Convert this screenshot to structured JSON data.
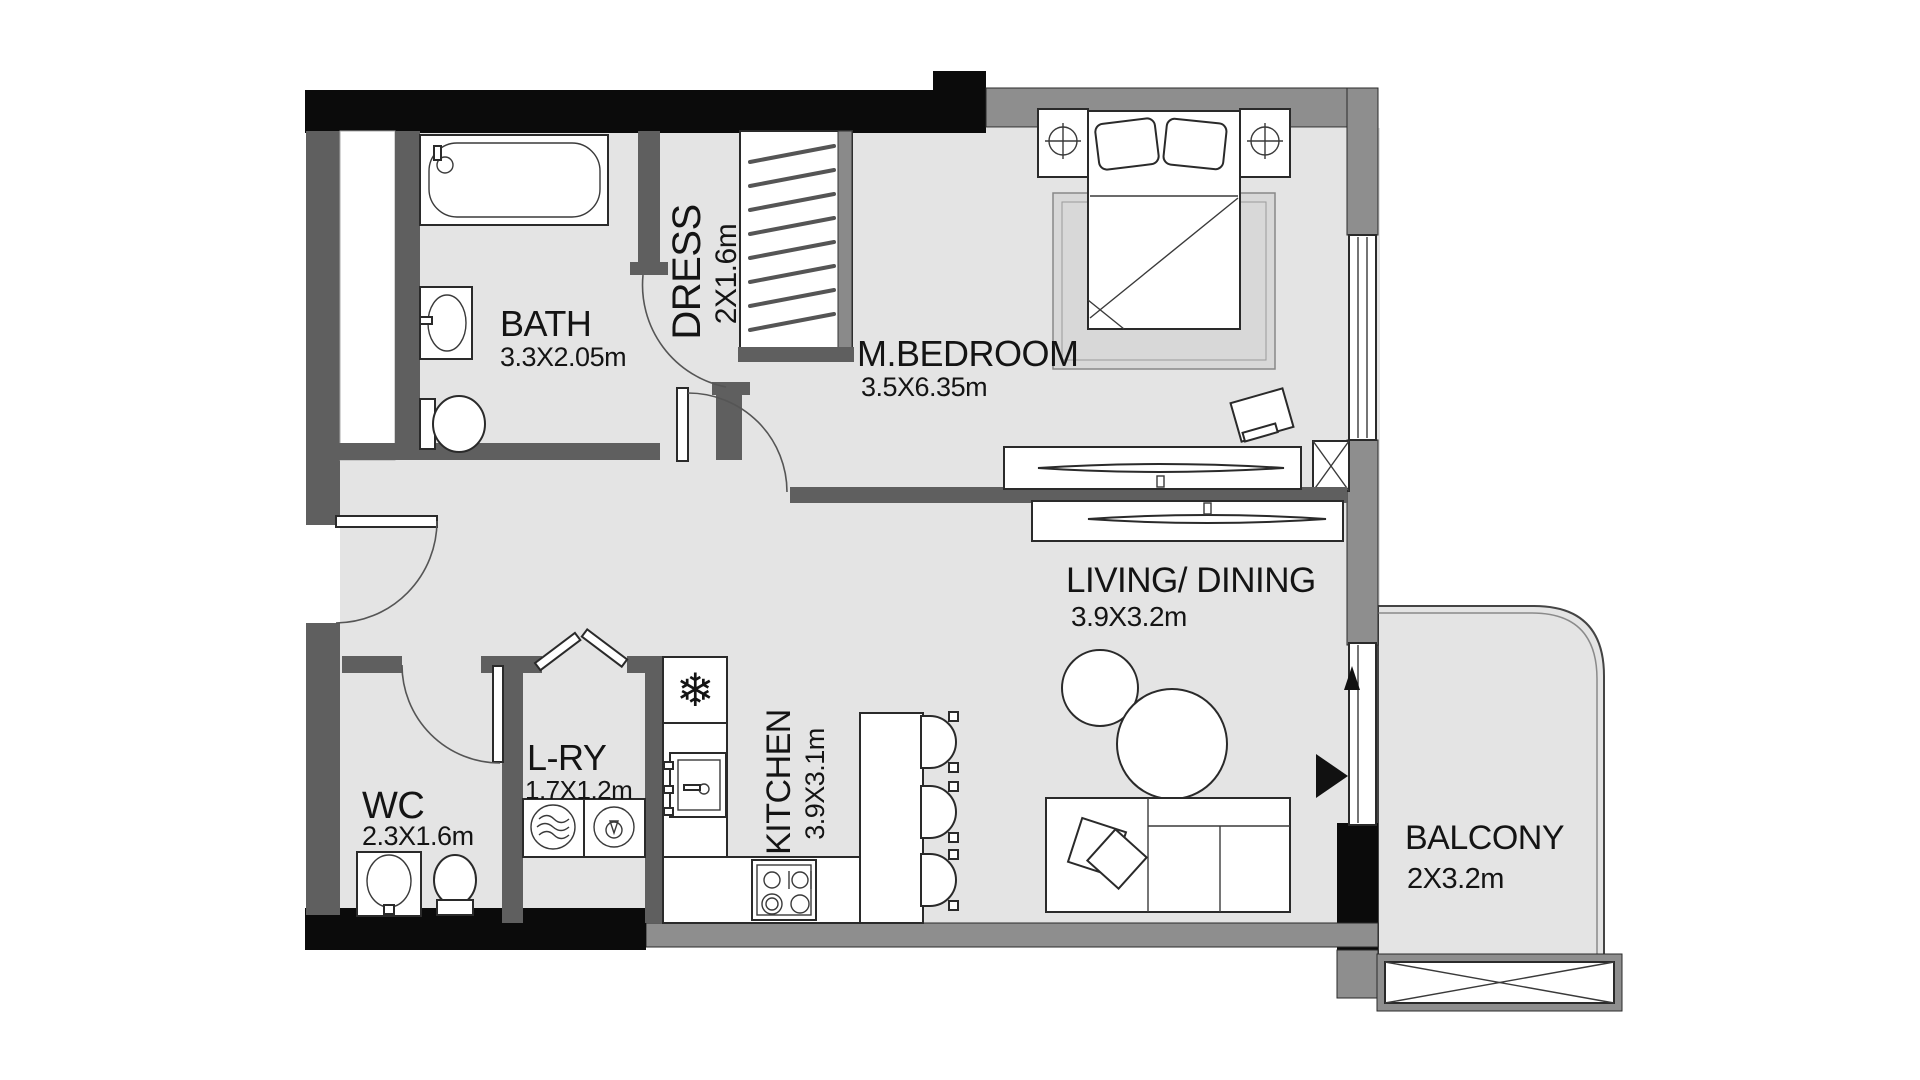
{
  "title": "Apartment floor plan",
  "palette": {
    "floor": "#e4e4e4",
    "wall-black": "#0b0b0b",
    "wall-gray": "#8e8e8e",
    "wall-dark": "#5f5f5f",
    "rug": "#d8d8d8",
    "text": "#141414"
  },
  "rooms": {
    "bath": {
      "name": "BATH",
      "dims": "3.3X2.05m"
    },
    "dress": {
      "name": "DRESS",
      "dims": "2X1.6m"
    },
    "master_bedroom": {
      "name": "M.BEDROOM",
      "dims": "3.5X6.35m"
    },
    "living_dining": {
      "name": "LIVING/ DINING",
      "dims": "3.9X3.2m"
    },
    "wc": {
      "name": "WC",
      "dims": "2.3X1.6m"
    },
    "laundry": {
      "name": "L-RY",
      "dims": "1.7X1.2m"
    },
    "kitchen": {
      "name": "KITCHEN",
      "dims": "3.9X3.1m"
    },
    "balcony": {
      "name": "BALCONY",
      "dims": "2X3.2m"
    }
  },
  "icons": {
    "fridge_snowflake": "❄"
  }
}
